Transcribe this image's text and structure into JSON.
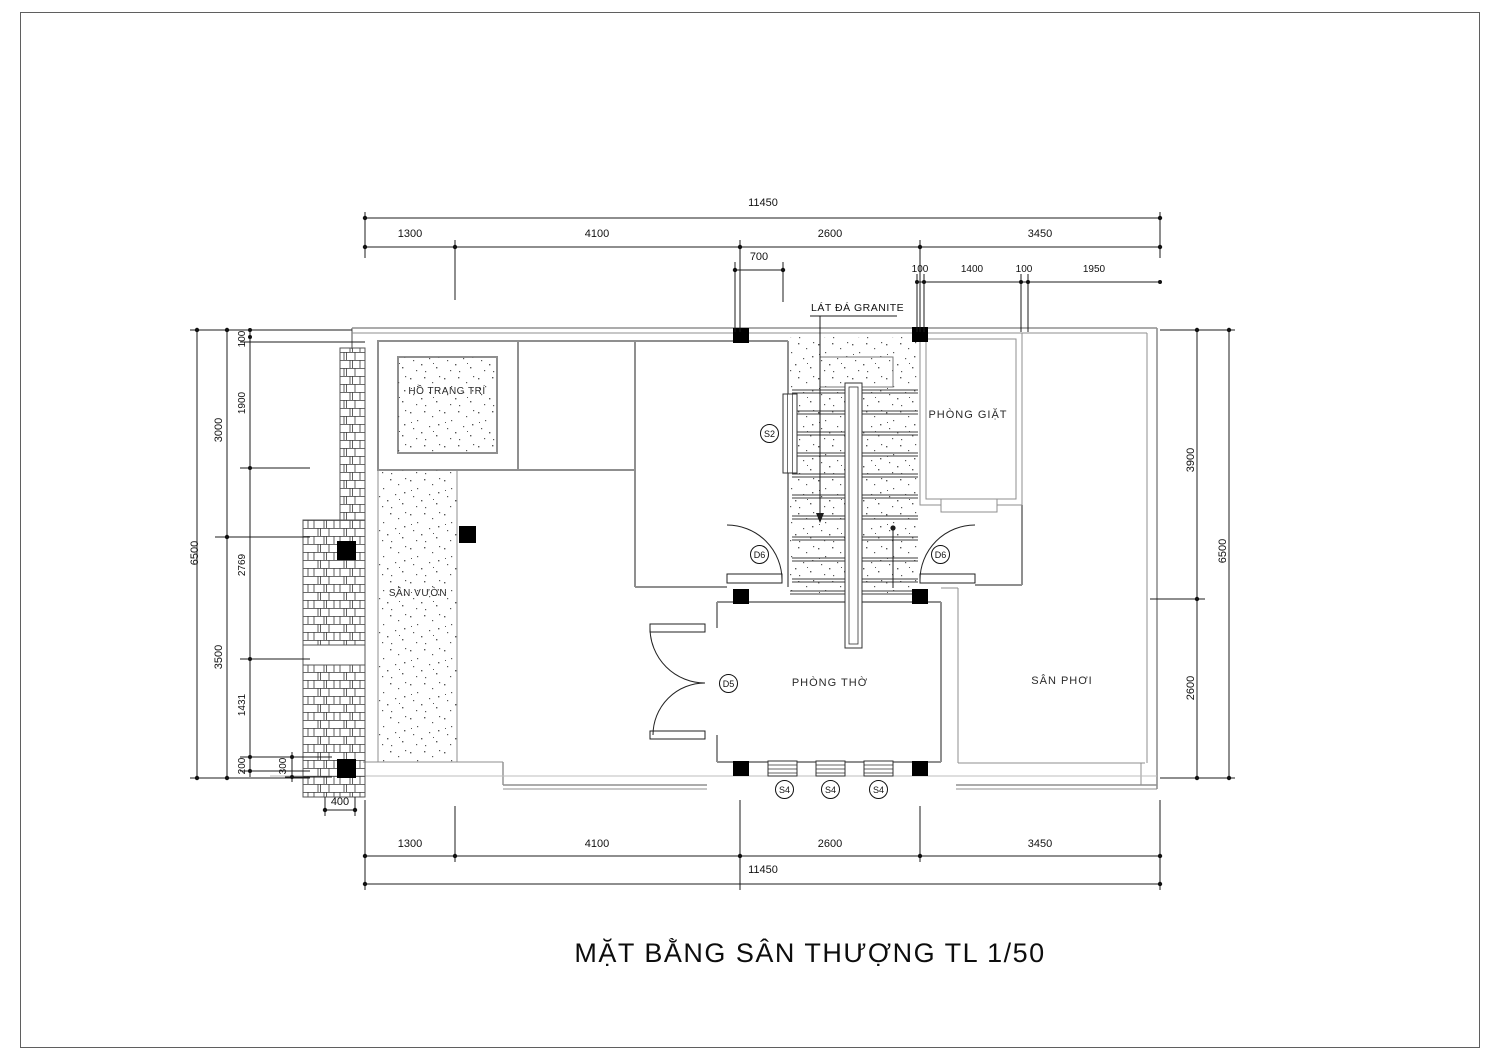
{
  "title": "MẶT BẰNG SÂN THƯỢNG TL 1/50",
  "annotations": {
    "granite_note": "LÁT ĐÁ GRANITE"
  },
  "rooms": {
    "decorative_pond": "HỒ TRANG TRÍ",
    "garden": "SÂN VƯỜN",
    "laundry": "PHÒNG GIẶT",
    "worship": "PHÒNG THỜ",
    "drying_yard": "SÂN PHƠI"
  },
  "tags": {
    "stair_window": "S2",
    "hall_door_left": "D6",
    "hall_door_right": "D6",
    "worship_door": "D5",
    "worship_window_1": "S4",
    "worship_window_2": "S4",
    "worship_window_3": "S4"
  },
  "dims": {
    "top": {
      "overall": "11450",
      "chain": [
        "1300",
        "4100",
        "2600",
        "3450"
      ],
      "offset": "700",
      "detail": [
        "100",
        "1400",
        "100",
        "1950"
      ]
    },
    "bottom": {
      "chain": [
        "1300",
        "4100",
        "2600",
        "3450"
      ],
      "overall": "11450"
    },
    "left": {
      "overall": "6500",
      "chain": [
        "3000",
        "3500"
      ],
      "detail": [
        "100",
        "1900",
        "2769",
        "1431",
        "200"
      ],
      "ledge_depth": "300",
      "ledge_width": "400"
    },
    "right": {
      "chain": [
        "3900",
        "2600"
      ],
      "overall": "6500"
    }
  }
}
